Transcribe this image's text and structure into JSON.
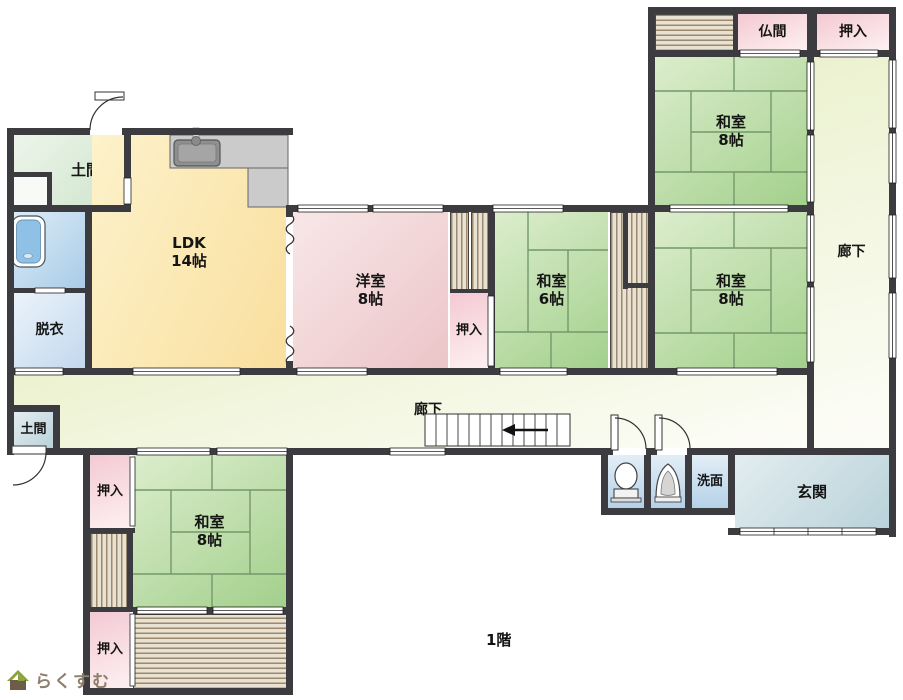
{
  "floor_label": "1階",
  "logo": {
    "text": "らくすむ",
    "icon": "house-icon"
  },
  "rooms": {
    "doma_top": {
      "label": "土間"
    },
    "ldk": {
      "label": "LDK",
      "size": "14帖"
    },
    "datsui": {
      "label": "脱衣"
    },
    "yoshitsu": {
      "label": "洋室",
      "size": "8帖"
    },
    "oshiire_mid": {
      "label": "押入"
    },
    "washitsu6": {
      "label": "和室",
      "size": "6帖"
    },
    "washitsu8_tr": {
      "label": "和室",
      "size": "8帖"
    },
    "butsuma": {
      "label": "仏間"
    },
    "oshiire_tr": {
      "label": "押入"
    },
    "rouka_v": {
      "label": "廊下"
    },
    "washitsu8_mr": {
      "label": "和室",
      "size": "8帖"
    },
    "rouka_h": {
      "label": "廊下"
    },
    "doma_small": {
      "label": "土間"
    },
    "oshiire_bl_top": {
      "label": "押入"
    },
    "washitsu8_bl": {
      "label": "和室",
      "size": "8帖"
    },
    "oshiire_bl_bottom": {
      "label": "押入"
    },
    "senmen": {
      "label": "洗面"
    },
    "genkan": {
      "label": "玄関"
    }
  },
  "colors": {
    "wall": "#3b3b40",
    "tatami_green": "#a3d08c",
    "ldk_yellow": "#f9df9e",
    "western_pink": "#ecc5c8",
    "closet_pink": "#f4c9d3",
    "corridor_green": "#ecf2d0",
    "water_blue": "#b5d1e8",
    "entry_blue": "#b9d2da",
    "stripe_brown": "#9c8a70",
    "logo_brown": "#8d7e6c"
  }
}
